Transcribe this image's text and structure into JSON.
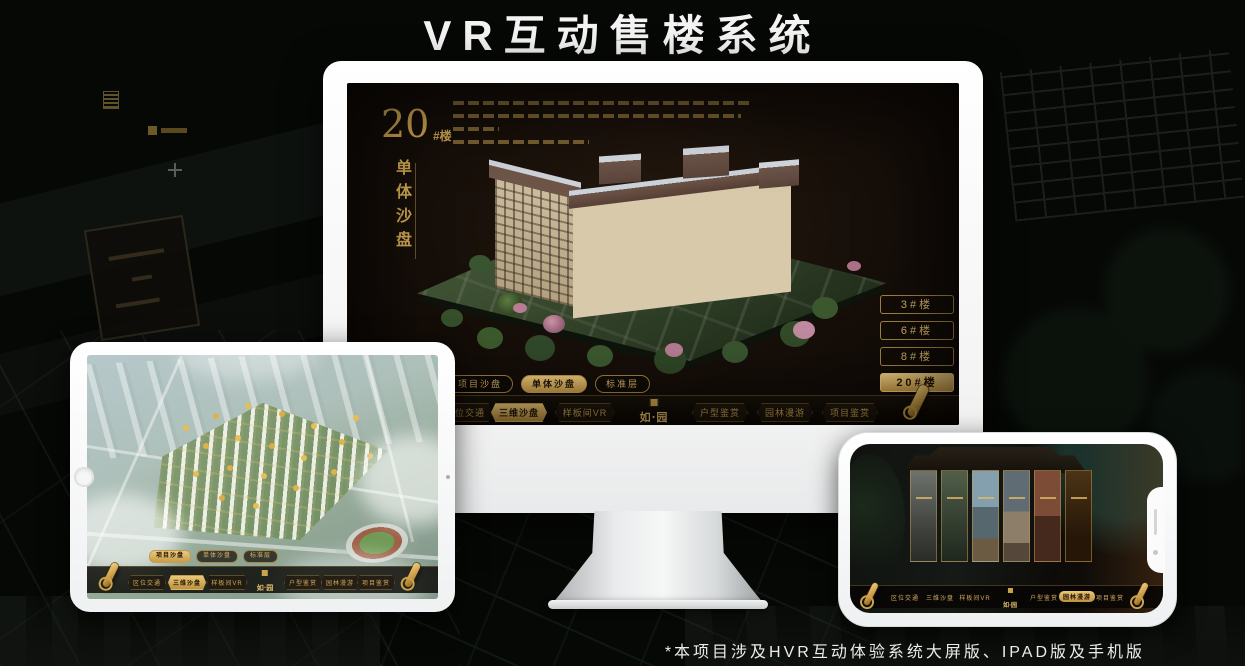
{
  "page": {
    "title": "VR互动售楼系统",
    "footnote": "*本项目涉及HVR互动体验系统大屏版、IPAD版及手机版"
  },
  "colors": {
    "gold": "#c9a24f",
    "gold_bright": "#e3bd6d",
    "screen_bg": "#170f09",
    "page_bg": "#060805"
  },
  "nav": {
    "items": [
      "区位交通",
      "三维沙盘",
      "样板间VR",
      "户型鉴赏",
      "园林漫游",
      "项目鉴赏"
    ],
    "logo_text": "如·园"
  },
  "tabs": {
    "items": [
      "项目沙盘",
      "单体沙盘",
      "标准层"
    ]
  },
  "monitor": {
    "heading_number": "20",
    "heading_suffix": "#楼",
    "heading_vertical": "单体沙盘",
    "building_buttons": [
      "3#楼",
      "6#楼",
      "8#楼",
      "20#楼"
    ],
    "active_building": "20#楼",
    "active_tab": "单体沙盘",
    "active_nav": "三维沙盘"
  },
  "ipad": {
    "active_tab": "项目沙盘",
    "active_nav": "三维沙盘"
  },
  "phone": {
    "active_nav": "园林漫游"
  }
}
